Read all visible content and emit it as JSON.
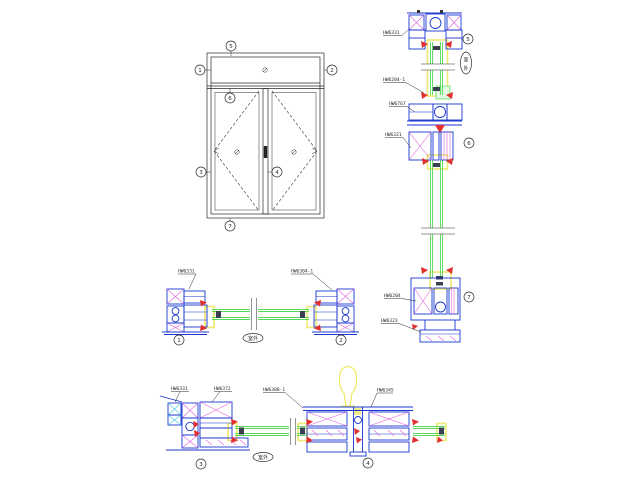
{
  "title": "铝合金门窗节点图 (aluminium door/window section details)",
  "colors": {
    "profile": "#1835cf",
    "glass": "#57d957",
    "glass_fill": "#e2f9e2",
    "yellow": "#f0ea6e",
    "red": "#e23030",
    "hatch": "#de64de",
    "cyan": "#49c8e0",
    "line": "#2a2a2a",
    "dark": "#39404f"
  },
  "elevation": {
    "callouts": {
      "top": "5",
      "left": "1",
      "right": "2",
      "transom": "6",
      "bottom_left": "3",
      "bottom_center": "4",
      "bottom": "7"
    }
  },
  "right_stack": {
    "part_labels": [
      "HW6331",
      "HW6204-1",
      "HW6767",
      "HW6321",
      "HW6204",
      "HW6323"
    ],
    "callouts": [
      "5",
      "6",
      "7"
    ],
    "orientation_label": "室外",
    "orientation_chars": [
      "室",
      "外"
    ]
  },
  "middle_row": {
    "part_labels": [
      "HW6331",
      "HW6304-1"
    ],
    "callouts": [
      "1",
      "2"
    ],
    "orientation_label": "室外"
  },
  "bottom_row": {
    "part_labels": [
      "HW6331",
      "HW6372",
      "HW6308-1",
      "HW6345"
    ],
    "callouts": [
      "3",
      "4"
    ],
    "orientation_label": "室外"
  }
}
